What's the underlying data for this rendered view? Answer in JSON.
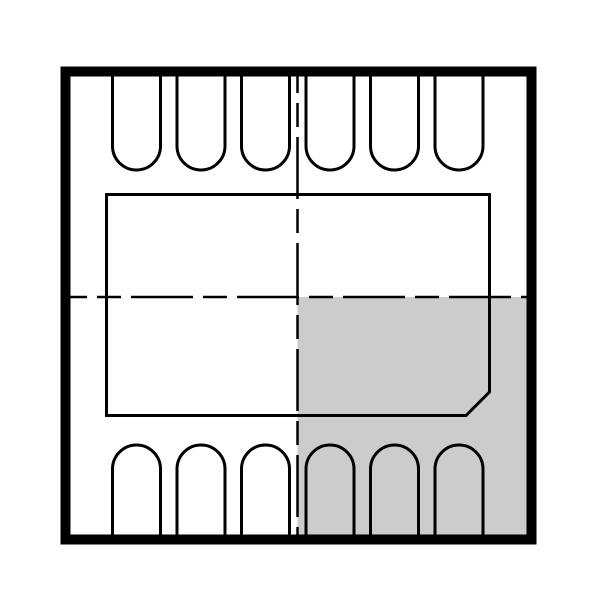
{
  "window": {
    "width": 600,
    "height": 599,
    "background": "#ffffff"
  },
  "drawing": {
    "kind": "dfn-package-outline-top-view",
    "colors": {
      "outline": "#000000",
      "shaded_region": "#cccccc",
      "background": "#ffffff"
    },
    "outer_body": {
      "x": 65.5,
      "y": 71.5,
      "width": 466,
      "height": 468,
      "stroke_width": 10
    },
    "exposed_pad": {
      "left": 106.5,
      "top": 194.5,
      "right": 489.5,
      "bottom": 415.5,
      "chamfer": 23.5,
      "stroke_width": 3
    },
    "shaded_quadrant": {
      "x": 297.5,
      "y": 297,
      "width": 230,
      "height": 238
    },
    "centerlines": {
      "vertical_x": 297.5,
      "vertical_y1": 71,
      "vertical_y2": 540,
      "horizontal_y": 297,
      "horizontal_x1": 65,
      "horizontal_x2": 531.5,
      "stroke_width": 2.5,
      "dash_array": "62 10 24 10",
      "dash_offset": 40
    },
    "pins": {
      "top_count": 6,
      "bottom_count": 6,
      "centers_x": [
        136.5,
        201,
        265.5,
        330,
        394.5,
        459
      ],
      "half_width": 24,
      "corner_radius": 24,
      "stroke_width": 3,
      "top_row": {
        "attach_y": 76.5,
        "straight_end_y": 146
      },
      "bottom_row": {
        "attach_y": 535.5,
        "straight_end_y": 469
      }
    }
  }
}
